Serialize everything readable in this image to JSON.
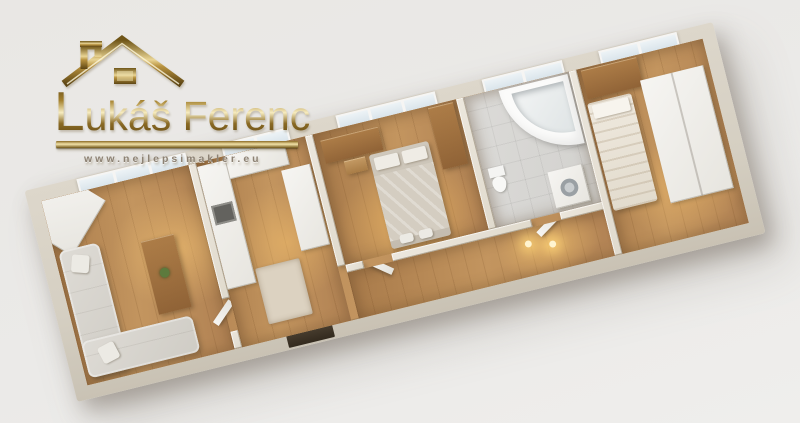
{
  "watermark": {
    "brand": "Lukáš Ferenc",
    "brand_initial": "L",
    "brand_rest": "ukáš Ferenc",
    "url": "www.nejlepsimakler.eu",
    "gold_dark": "#6f5517",
    "gold_light": "#f3e3a8"
  },
  "palette": {
    "background": "#eae8e5",
    "outer_wall": "#d5cfc2",
    "inner_wall": "#e6e0d4",
    "wood_floor": "#b88a57",
    "tile_floor": "#d8d7d4",
    "sofa": "#d6d3cc",
    "white_furniture": "#f3f2ef",
    "wood_furniture": "#a1713f",
    "window_glass": "#dde7ee",
    "warm_light": "#ffd678"
  },
  "floorplan": {
    "type": "3d-apartment-top-view",
    "rooms": [
      {
        "id": "living-room",
        "objects": [
          "window",
          "corner-wardrobe",
          "l-shaped-sofa",
          "throw-pillows",
          "tv-cabinet",
          "plant"
        ]
      },
      {
        "id": "kitchen",
        "objects": [
          "window",
          "cabinet-run",
          "oven",
          "counter",
          "rug"
        ]
      },
      {
        "id": "bedroom-middle",
        "objects": [
          "window",
          "desk",
          "chair",
          "wardrobe",
          "double-bed",
          "pillows"
        ]
      },
      {
        "id": "hallway",
        "objects": [
          "ceiling-spotlights",
          "open-door",
          "entrance-doorway"
        ]
      },
      {
        "id": "bathroom",
        "objects": [
          "window",
          "corner-bathtub",
          "toilet",
          "washing-machine"
        ]
      },
      {
        "id": "bedroom-right",
        "objects": [
          "window",
          "wooden-cabinet",
          "single-bed",
          "white-wardrobe"
        ]
      }
    ]
  }
}
